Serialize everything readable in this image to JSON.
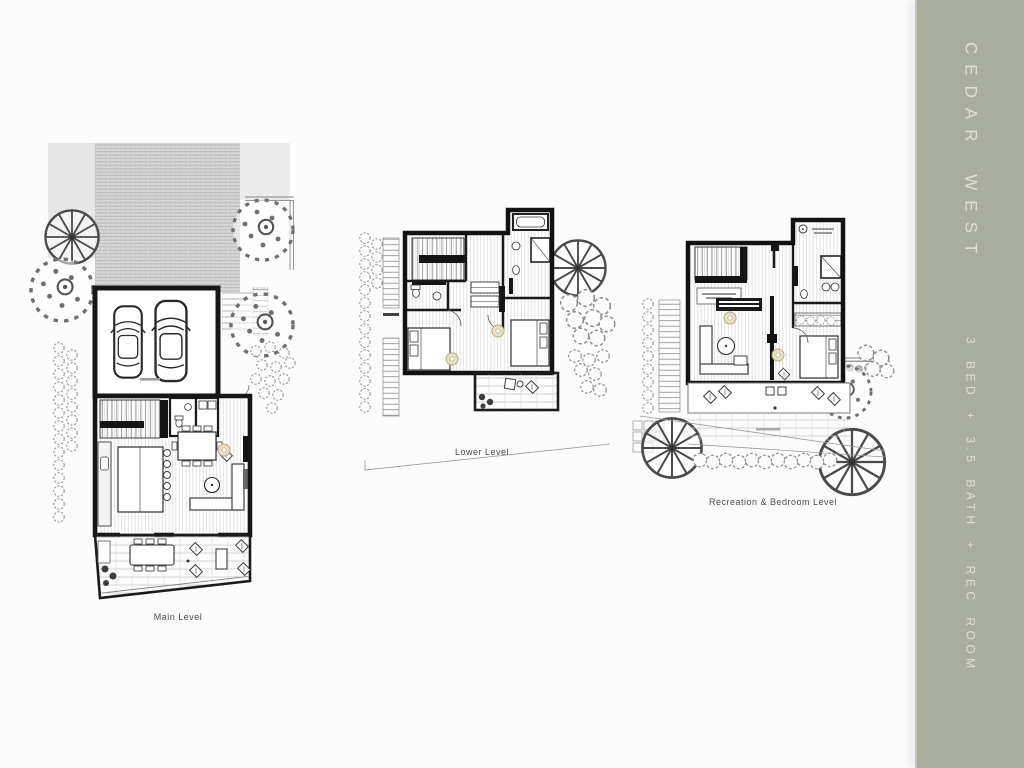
{
  "sidebar": {
    "title": "CEDAR WEST",
    "subtitle": "3 BED + 3.5 BATH + REC ROOM"
  },
  "plans": [
    {
      "label": "Main Level"
    },
    {
      "label": "Lower Level"
    },
    {
      "label": "Recreation & Bedroom Level"
    }
  ],
  "colors": {
    "sidebar_bg": "#a9ad9e",
    "sidebar_text": "#e6e3cf",
    "caption_text": "#4b4b4b"
  }
}
